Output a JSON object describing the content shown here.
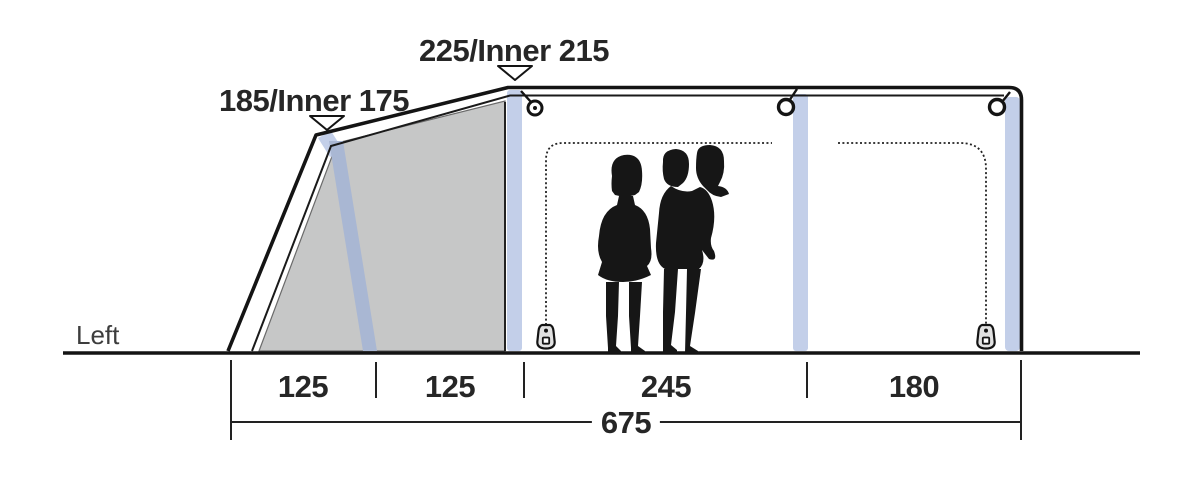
{
  "diagram": {
    "type": "tent-side-profile-dimension-drawing",
    "side_label": "Left",
    "height_labels": {
      "front_bend": "185/Inner 175",
      "main_peak": "225/Inner 215"
    },
    "floor_segments": [
      "125",
      "125",
      "245",
      "180"
    ],
    "total_length": "675",
    "colors": {
      "outline": "#141414",
      "air_pole_blue": "#c3cfe9",
      "panel_gray": "#c6c7c7",
      "panel_pole_blue": "#a9b7d3",
      "dimension_text": "#262626",
      "side_label_text": "#3d3d3d"
    }
  }
}
